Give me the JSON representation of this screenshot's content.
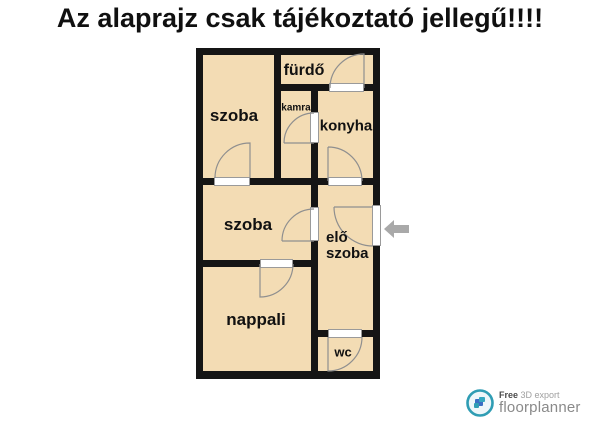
{
  "title": "Az alaprajz csak tájékoztató jellegű!!!!",
  "plan": {
    "rooms": {
      "szoba_top": {
        "label": "szoba"
      },
      "furdo": {
        "label": "fürdő"
      },
      "kamra": {
        "label": "kamra"
      },
      "konyha": {
        "label": "konyha"
      },
      "szoba_middle": {
        "label": "szoba"
      },
      "eloszoba": {
        "line1": "elő",
        "line2": "szoba"
      },
      "nappali": {
        "label": "nappali"
      },
      "wc": {
        "label": "wc"
      }
    },
    "entrance": {
      "arrow_icon": "left-arrow",
      "side": "right-wall"
    }
  },
  "colors": {
    "floor": "#f3dcb4",
    "wall": "#151515",
    "door_frame": "#9a9a9a",
    "door_arc": "#8f8f8f",
    "entrance_arrow": "#a9a9a9",
    "logo_teal": "#2f9db4",
    "logo_text": "#8a8a8a"
  },
  "footer_logo": {
    "free": "Free",
    "export_label": "3D export",
    "brand": "floorplanner"
  }
}
